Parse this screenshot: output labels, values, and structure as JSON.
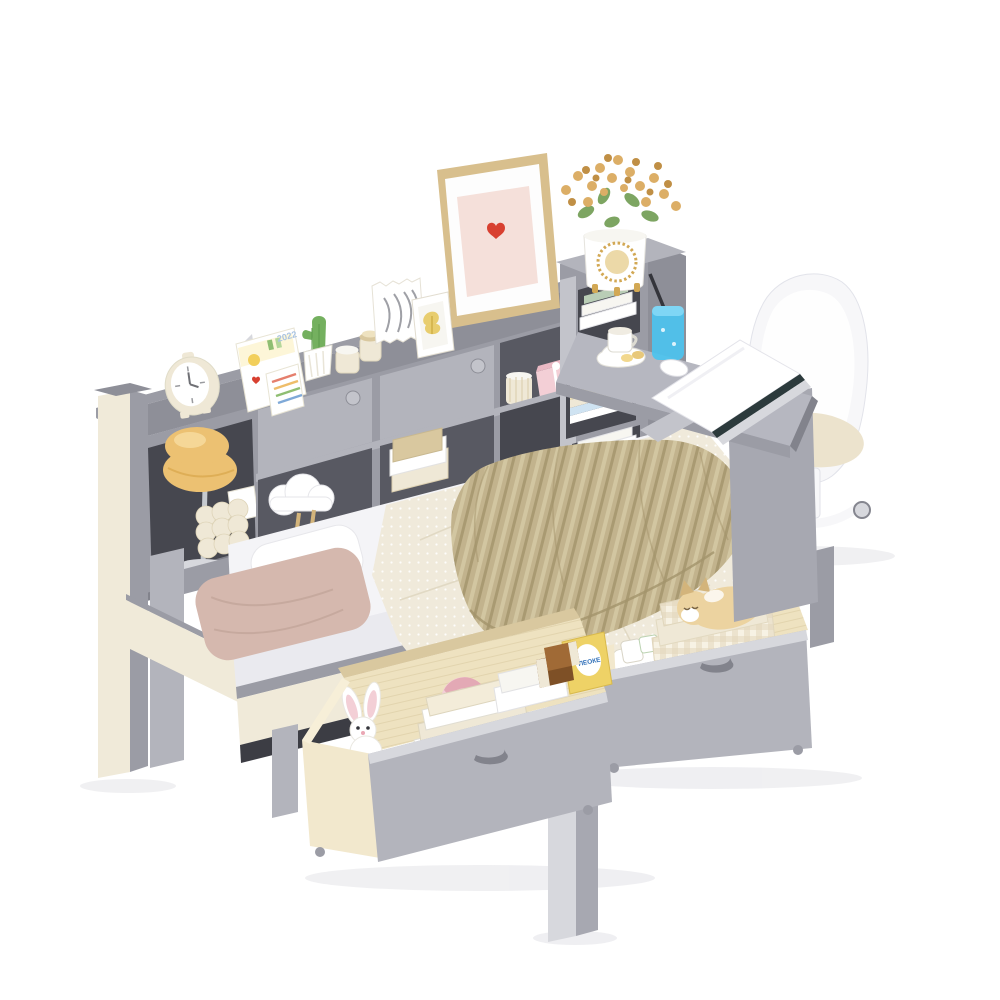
{
  "scene": {
    "description": "Product photo on white background: gray wood daybed with bookcase storage headboard, two pull-out under-bed storage drawers, attached corner desk tower with white swivel chair, styled with bedding, toys, books and decor.",
    "texts": {
      "calendar_year": "2022",
      "snack_brand": "ЛЕОКЕ"
    }
  },
  "colors": {
    "bg": "#ffffff",
    "shadow": "#eeeef1",
    "grayTop": "#8e8f98",
    "gray": "#9b9ca5",
    "grayDark": "#82838c",
    "cubby": "#585962",
    "cubbyDark": "#46474f",
    "grayLight": "#b3b4bc",
    "grayLighter": "#c3c4cb",
    "grayPale": "#d7d8dd",
    "panel": "#a7a8b1",
    "deskTop": "#b6b7c0",
    "mattress": "#f4f4f7",
    "mattressSide": "#eaeaef",
    "railCream": "#f0ead9",
    "underBed": "#3c3d44",
    "quilt": "#f0eadb",
    "khaki": "#c2b38d",
    "khakiDark": "#a3946c",
    "pinkPillow": "#d5b8ae",
    "pinkPillowDark": "#bd9e93",
    "wood": "#eee2c0",
    "woodLight": "#f7efd8",
    "woodDark": "#d9c89f",
    "woodSide": "#f2e8cd",
    "frameTan": "#d8bf8d",
    "mat": "#fdfdfd",
    "artPink": "#f5e0da",
    "heartRed": "#d84030",
    "gold": "#d2a854",
    "goldPale": "#ecd9a8",
    "flower": "#dcae66",
    "flowerDark": "#c08f45",
    "leaf": "#7da562",
    "leafDark": "#5d874a",
    "cactus": "#74b05f",
    "white": "#ffffff",
    "offWhite": "#f7f6f1",
    "cream": "#efe8d6",
    "amber": "#ecc172",
    "amberDark": "#d9a54a",
    "chrome": "#c6cacf",
    "chromeDark": "#99a0a8",
    "blue": "#4cc3ef",
    "blueDark": "#1791c6",
    "chair": "#f7f7f9",
    "chairShade": "#e4e5ec",
    "cushion": "#ece3cd",
    "plushPink": "#f3cfd6",
    "plushPinkDark": "#e3a9b5",
    "plushTan": "#ecd3a0",
    "plushTanDark": "#d3b47b",
    "snackYellow": "#eed266",
    "snackBrown": "#7e5026",
    "labelBlue": "#2f6fb8",
    "calBlue": "#a9c3e2",
    "dark": "#34353b"
  }
}
